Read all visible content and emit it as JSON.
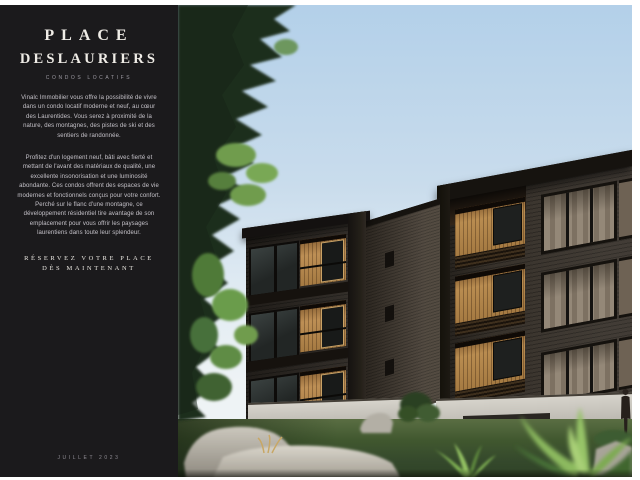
{
  "sidebar": {
    "title_line1": "PLACE",
    "title_line2": "DESLAURIERS",
    "subtitle": "CONDOS LOCATIFS",
    "intro_paragraph": "Vinalc Immobilier vous offre la possibilité de vivre dans un condo locatif moderne et neuf, au cœur des Laurentides. Vous serez à proximité de la nature, des montagnes, des pistes de ski et des sentiers de randonnée.",
    "body_paragraph": "Profitez d'un logement neuf, bâti avec fierté et mettant de l'avant des matériaux de qualité, une excellente insonorisation et une luminosité abondante. Ces condos offrent des espaces de vie modernes et fonctionnels conçus pour votre confort. Perché sur le flanc d'une montagne, ce développement résidentiel tire avantage de son emplacement pour vous offrir les paysages laurentiens dans toute leur splendeur.",
    "cta_line1": "RÉSERVEZ VOTRE PLACE",
    "cta_line2": "DÈS MAINTENANT",
    "footer_date": "JUILLET 2023",
    "colors": {
      "background": "#1b1a1c",
      "title_text": "#efece6",
      "body_text": "#c6c3ca",
      "muted_text": "#8f8c93"
    }
  },
  "rendering": {
    "alt": "3D architectural rendering of two modern dark-brick condo buildings with recessed golden-wood balconies, conifer trees at left, gray boulders and lawn in front, bright ferns at bottom right, small human figure at far right, clear blue sky",
    "colors": {
      "sky_top": "#b3d0e9",
      "sky_horizon": "#eef3f5",
      "facade_dark": "#2b2621",
      "facade_right": "#38322b",
      "wood_accent": "#b5884e",
      "foundation": "#cdcac2",
      "lawn": "#41582f",
      "rock": "#c8c4ba",
      "foliage_dark": "#1f2d1d",
      "foliage_bright": "#6f9c4e"
    }
  }
}
